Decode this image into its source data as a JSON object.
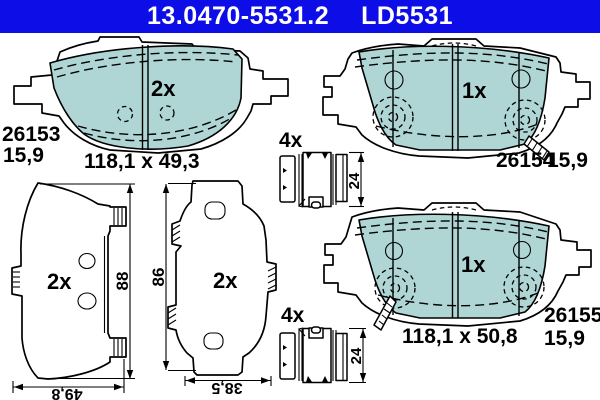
{
  "header": {
    "part_number": "13.0470-5531.2",
    "reference_code": "LD5531"
  },
  "colors": {
    "header_blue": "#0d0de8",
    "friction_material": "#afd6d5",
    "line": "#000000",
    "background": "#ffffff"
  },
  "pads": {
    "inner_pad": {
      "quantity": "2x",
      "article": "26153",
      "thickness": "15,9",
      "dimensions": "118,1 x 49,3"
    },
    "outer_pad_left": {
      "quantity": "1x",
      "article": "26154",
      "thickness": "15,9"
    },
    "outer_pad_right": {
      "quantity": "1x",
      "article": "26155",
      "thickness": "15,9",
      "dimensions": "118,1 x 50,8"
    }
  },
  "back_views": {
    "view1": {
      "quantity": "2x",
      "height": "88",
      "width": "49,8"
    },
    "view2": {
      "quantity": "2x",
      "height": "86",
      "width": "38,5"
    }
  },
  "clips": {
    "clip_top": {
      "quantity": "4x",
      "height": "24"
    },
    "clip_bottom": {
      "quantity": "4x",
      "height": "24"
    }
  }
}
